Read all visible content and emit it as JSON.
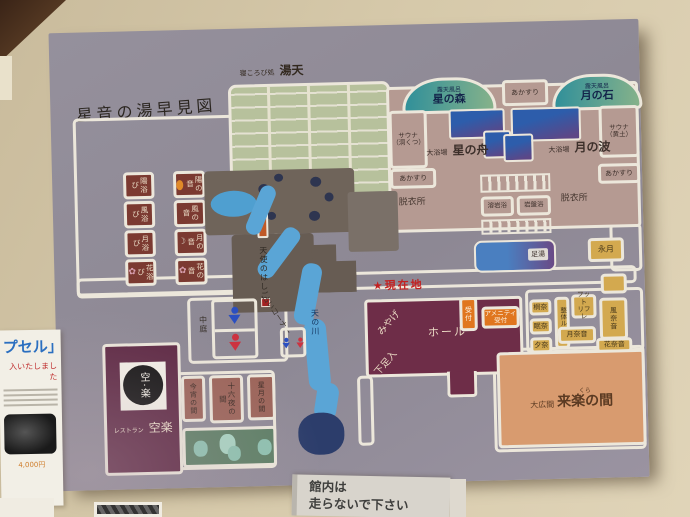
{
  "map": {
    "title": "星音の湯早見図",
    "current_location": "★現在地",
    "baths": {
      "yuten_prefix": "寝ころび処",
      "yuten": "湯天",
      "hoshinomori_prefix": "露天風呂",
      "hoshinomori": "星の森",
      "tsukinoishi_prefix": "露天風呂",
      "tsukinoishi": "月の石",
      "hoshinofune_prefix": "大浴場",
      "hoshinofune": "星の舟",
      "tsukinonami_prefix": "大浴場",
      "tsukinonami": "月の波",
      "akasuri": "あかすり",
      "sauna": "サウナ",
      "sauna_cave": "（洞くつ）",
      "sauna_ocher": "（黄土）",
      "datsuijo": "脱衣所",
      "yoganyoku": "溶岩浴",
      "ganbanyoku": "岩盤浴",
      "ashiyu": "足湯"
    },
    "family_baths_left": [
      "陽浴び",
      "風浴び",
      "月浴び",
      "花浴び"
    ],
    "family_baths_right": [
      "陽の音",
      "風の音",
      "月の音",
      "花の音"
    ],
    "center": {
      "tenshi_no_hashigo": "天使のはしご",
      "amanogawa": "天の川",
      "nakaniwa": "中庭",
      "uranai_corner": "占いコーナー"
    },
    "front": {
      "miyage": "みやげ",
      "hall": "ホール",
      "gesokuire": "下足入",
      "uketsuke": "受付",
      "amenity_line1": "アメニティ",
      "amenity_line2": "受付"
    },
    "relax": {
      "eigetsu": "永月",
      "seitai_room": "整体ルーム",
      "foot_line1": "フット",
      "foot_line2": "リフレ",
      "kazanane": "風奈音",
      "tsukinane": "月奈音",
      "hananane": "花奈音",
      "booth1": "桐奈",
      "booth2": "眠奈",
      "booth3": "夕奈"
    },
    "rooms": {
      "oohiroma_prefix": "大広間",
      "kura_furigana": "くら",
      "kuraku_no_ma": "来楽の間",
      "koyoi": "今宵の間",
      "izayoi": "十六夜の間",
      "hoshizuki": "星月の間"
    },
    "restaurant": {
      "prefix": "レストラン",
      "name": "空楽",
      "logo_top": "空",
      "logo_mid": "・",
      "logo_bottom": "楽"
    },
    "icons": {
      "flower": "✿",
      "moon": "☽"
    }
  },
  "wall": {
    "sign_line1": "館内は",
    "sign_line2": "走らないで下さい",
    "poster_title_fragment": "プセル」",
    "poster_sub_fragment": "入いたしました",
    "poster_price": "4,000円"
  }
}
